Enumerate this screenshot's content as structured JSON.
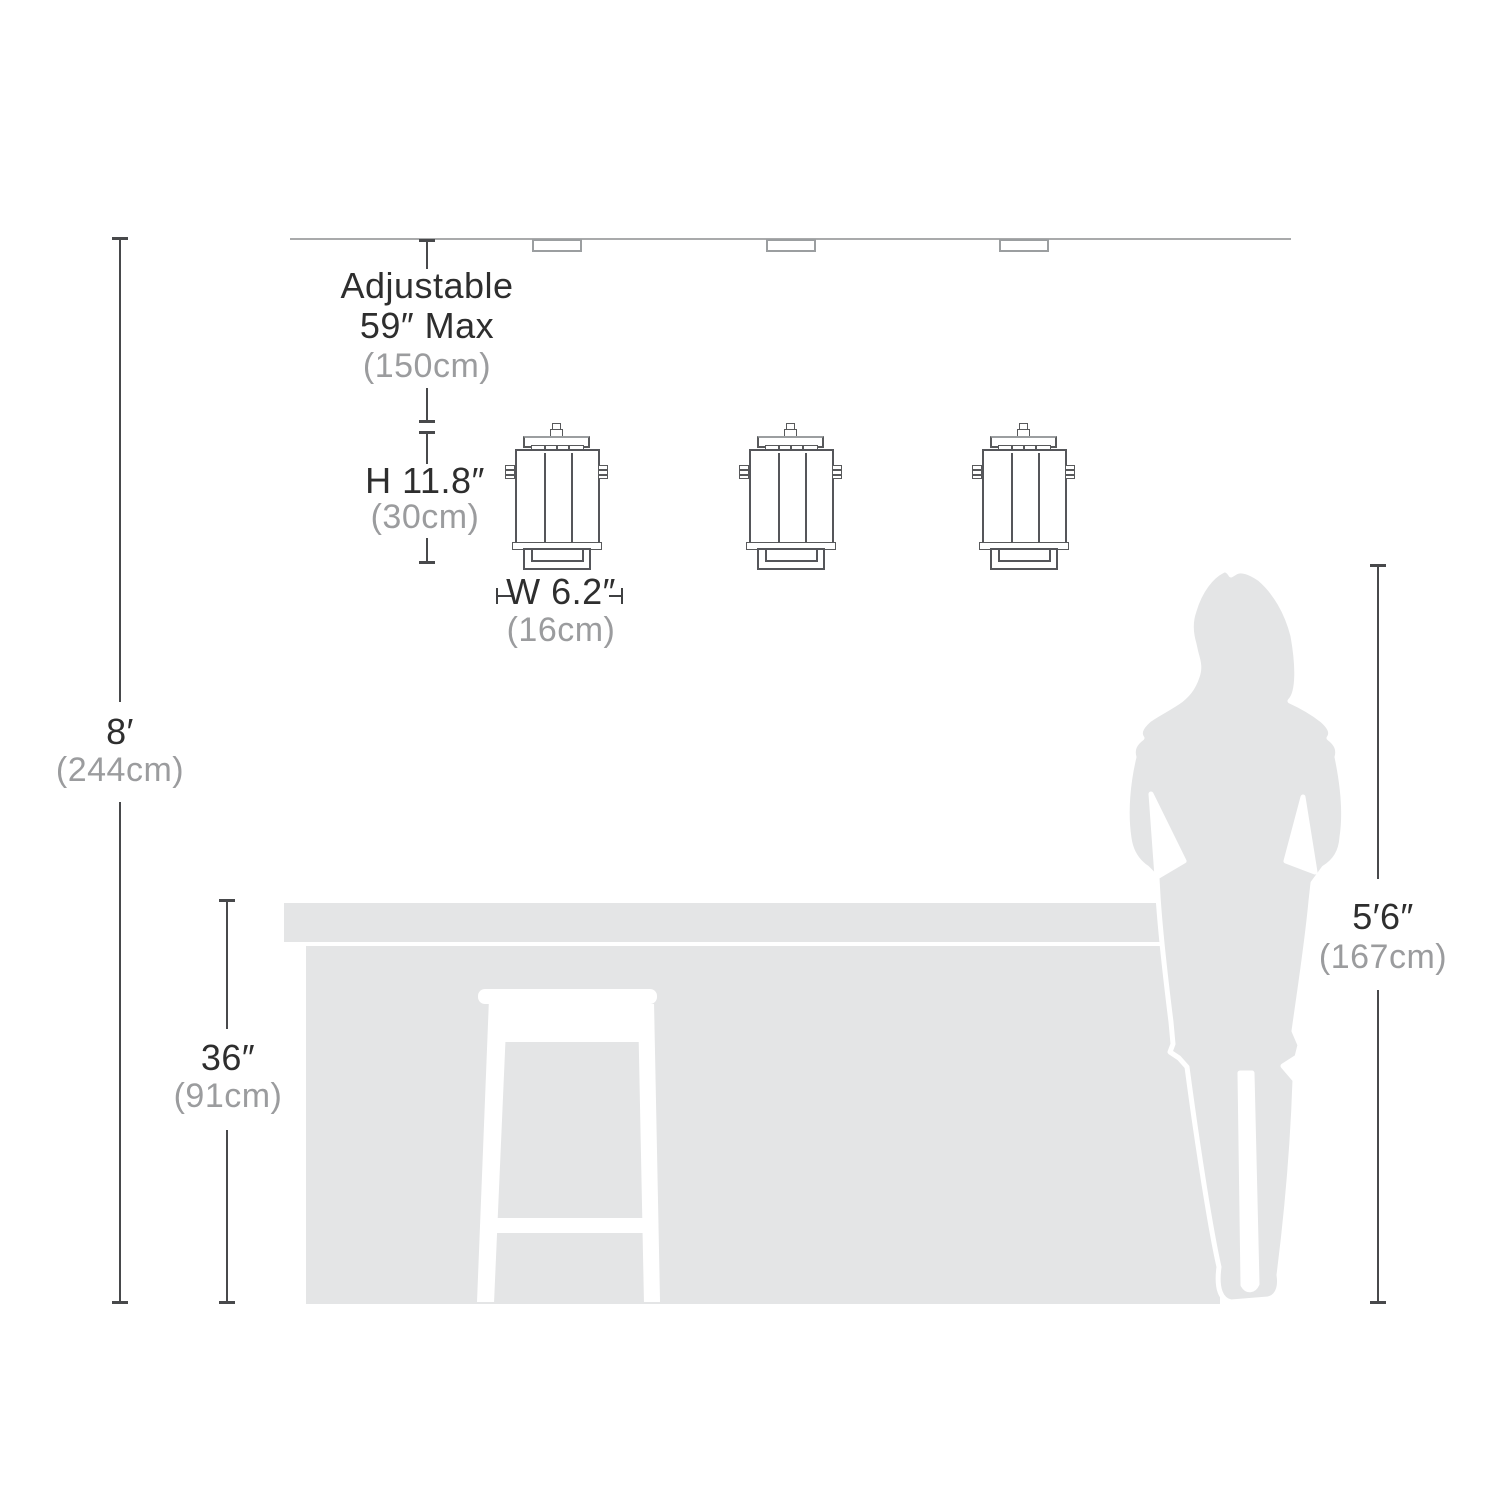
{
  "colors": {
    "silhouette_gray": "#e4e5e6",
    "dim_line_dark": "#48494b",
    "ceiling_line_gray": "#a9aaab",
    "pendant_outline": "#55565a",
    "text_dark": "#2e2e2e",
    "text_gray": "#9b9c9e"
  },
  "dimensions": {
    "adjustable_drop": {
      "line1": "Adjustable",
      "line2": "59″ Max",
      "metric": "(150cm)"
    },
    "fixture_height": {
      "imperial": "H 11.8″",
      "metric": "(30cm)"
    },
    "fixture_width": {
      "imperial": "W 6.2″",
      "metric": "(16cm)"
    },
    "ceiling_height": {
      "imperial": "8′",
      "metric": "(244cm)"
    },
    "counter_height": {
      "imperial": "36″",
      "metric": "(91cm)"
    },
    "person_height": {
      "imperial": "5′6″",
      "metric": "(167cm)"
    }
  }
}
